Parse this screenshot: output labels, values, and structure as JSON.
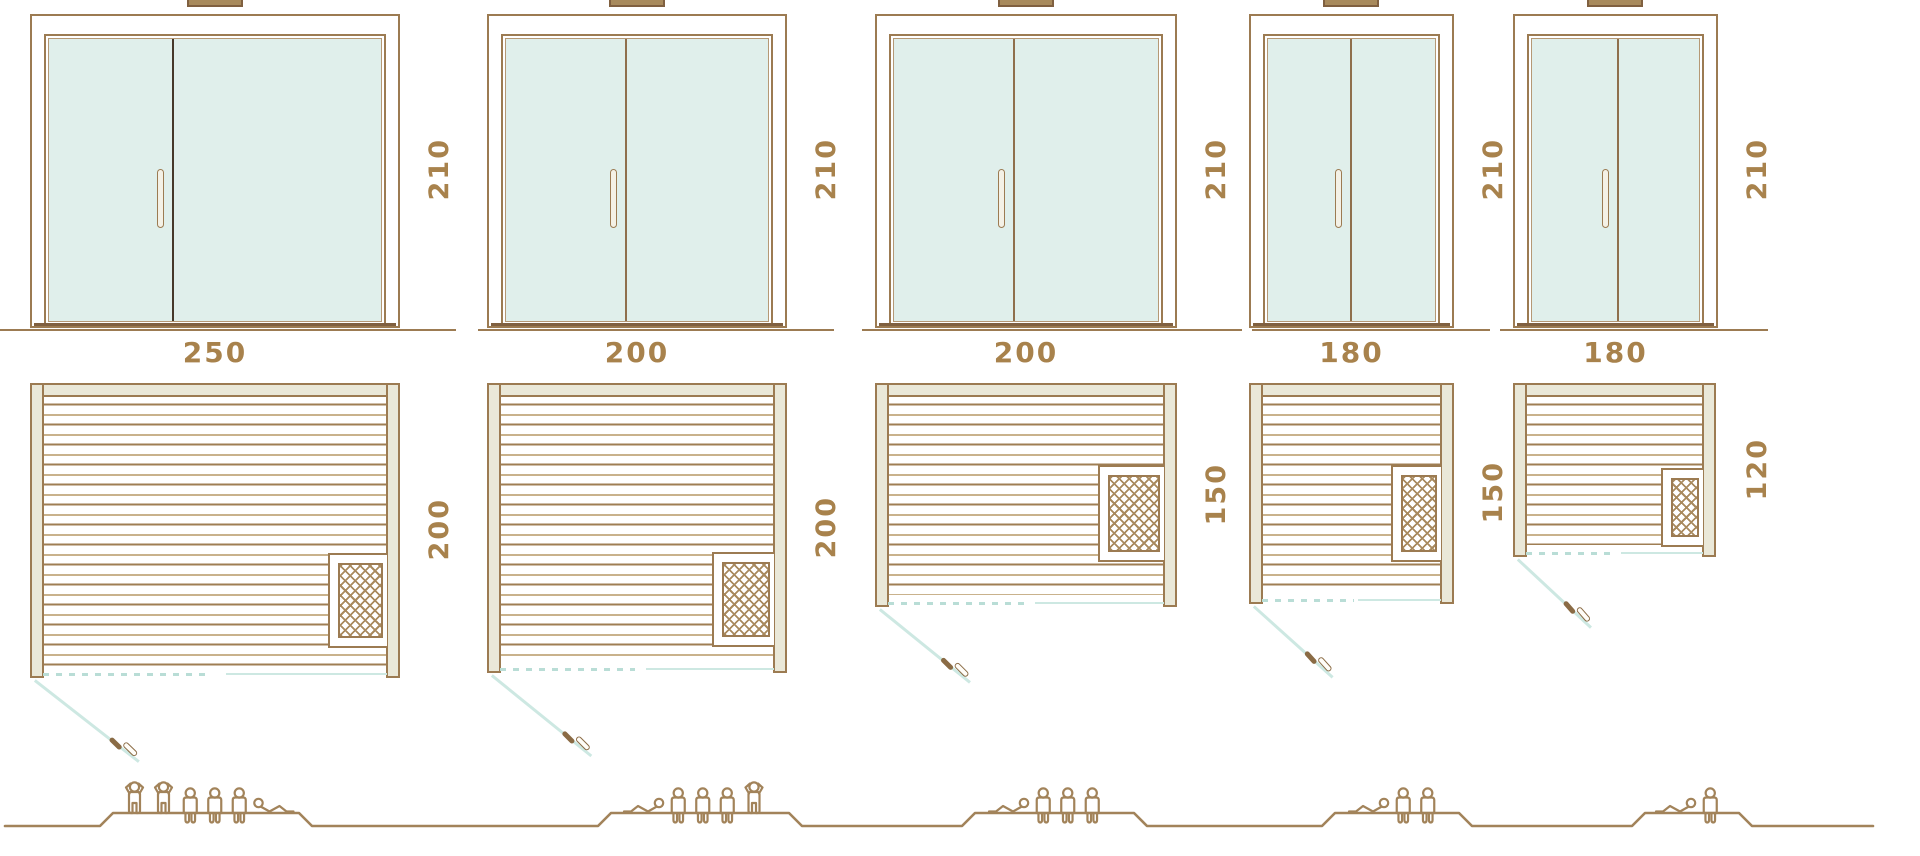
{
  "colors": {
    "outline_brown": "#9c7b52",
    "dark_brown": "#806040",
    "label_brown": "#a8824c",
    "wall_cream": "#eae8d8",
    "glass_mint": "#e0efeb",
    "door_swing_teal": "#cde8e2",
    "door_dash_teal": "#b9ddd6",
    "people_brown": "#a2835a"
  },
  "saunas": [
    {
      "name": "sauna-250x200",
      "width_label": "250",
      "elevation_height_label": "210",
      "plan_depth_label": "200",
      "capacity": 6,
      "occupants": [
        "standing",
        "standing",
        "sitting",
        "sitting",
        "sitting",
        "lying_r"
      ]
    },
    {
      "name": "sauna-200x200",
      "width_label": "200",
      "elevation_height_label": "210",
      "plan_depth_label": "200",
      "capacity": 5,
      "occupants": [
        "lying",
        "sitting",
        "sitting",
        "sitting",
        "standing"
      ]
    },
    {
      "name": "sauna-200x150",
      "width_label": "200",
      "elevation_height_label": "210",
      "plan_depth_label": "150",
      "capacity": 4,
      "occupants": [
        "lying",
        "sitting",
        "sitting",
        "sitting"
      ]
    },
    {
      "name": "sauna-180x150",
      "width_label": "180",
      "elevation_height_label": "210",
      "plan_depth_label": "150",
      "capacity": 3,
      "occupants": [
        "lying",
        "sitting",
        "sitting"
      ]
    },
    {
      "name": "sauna-180x120",
      "width_label": "180",
      "elevation_height_label": "210",
      "plan_depth_label": "120",
      "capacity": 2,
      "occupants": [
        "lying",
        "sitting"
      ]
    }
  ]
}
